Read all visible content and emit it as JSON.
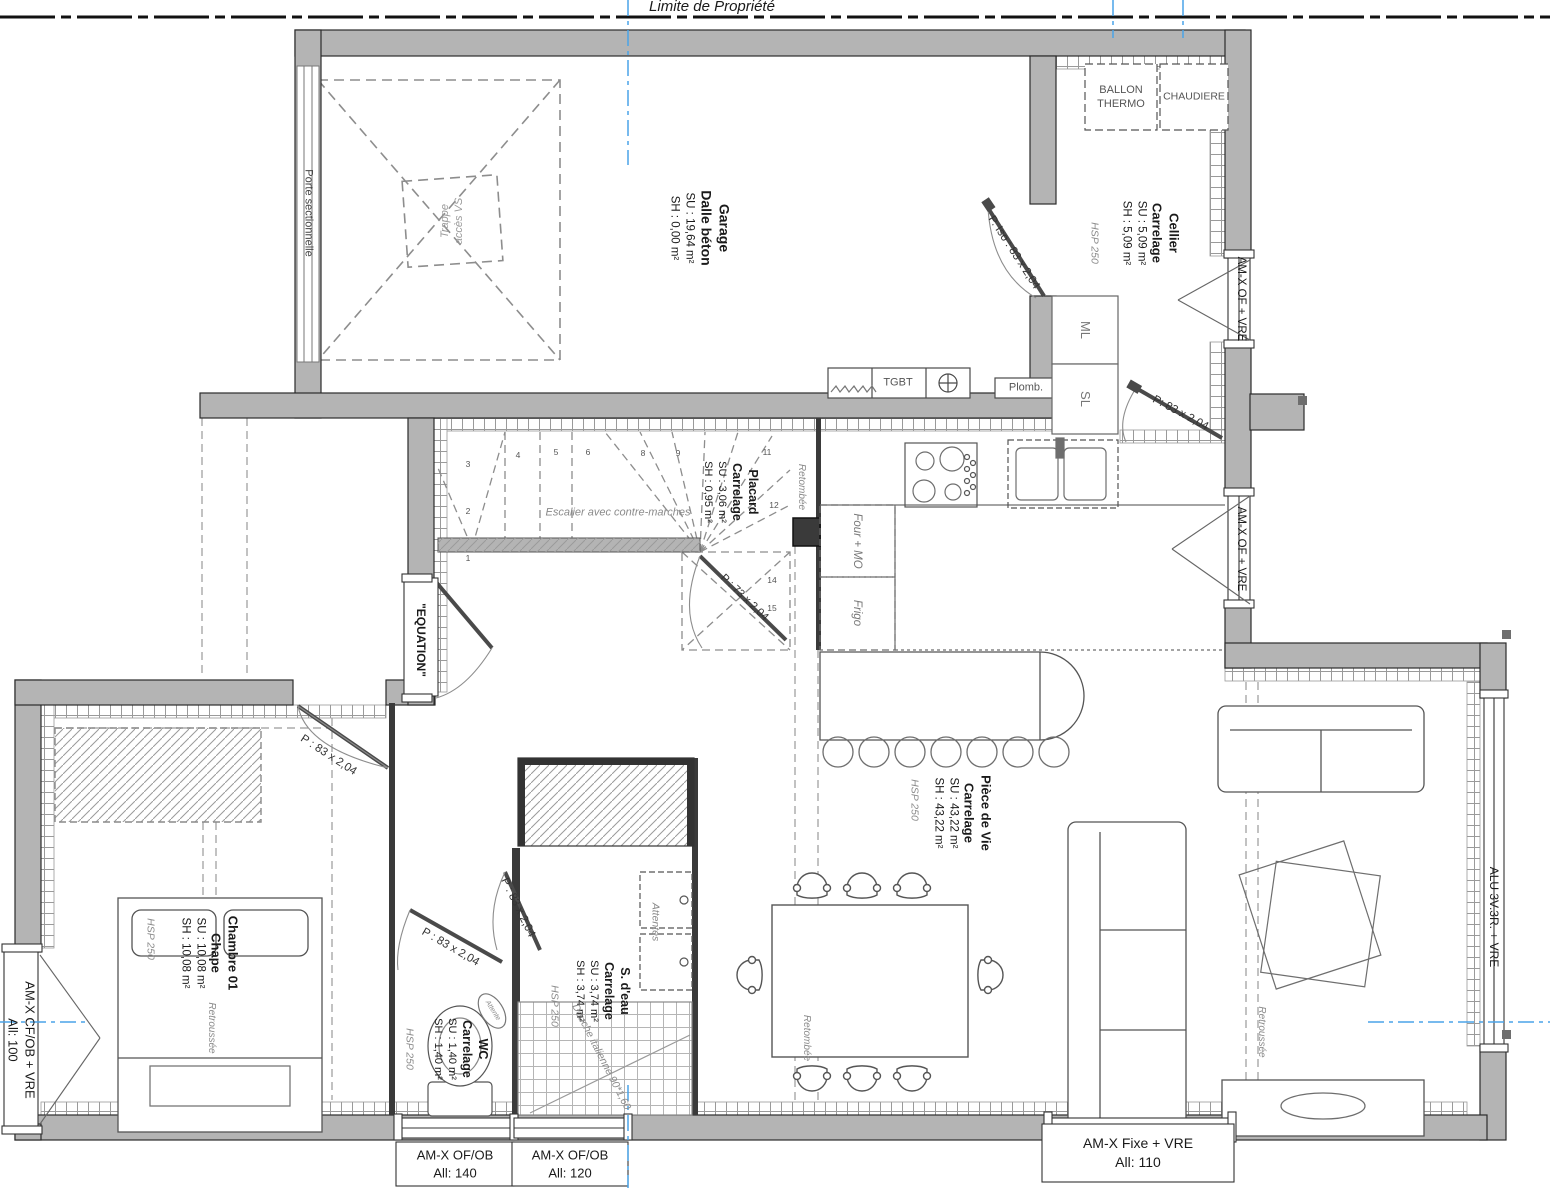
{
  "property_line_label": "Limite de Propriété",
  "colors": {
    "wall": "#b4b4b4",
    "axis_blue": "#4aa3e8",
    "muted_text": "#8a8a8a",
    "line": "#2e2e2e"
  },
  "rooms": {
    "garage": {
      "name": "Garage",
      "floor": "Dalle béton",
      "su": "SU : 19,64 m²",
      "sh": "SH : 0,00 m²"
    },
    "cellier": {
      "name": "Cellier",
      "floor": "Carrelage",
      "su": "SU : 5,09 m²",
      "sh": "SH : 5,09 m²",
      "hsp": "HSP 250"
    },
    "placard": {
      "name": "Placard",
      "floor": "Carrelage",
      "su": "SU : 3,06 m²",
      "sh": "SH : 0,95 m²"
    },
    "piece_de_vie": {
      "name": "Pièce de Vie",
      "floor": "Carrelage",
      "su": "SU : 43,22 m²",
      "sh": "SH : 43,22 m²",
      "hsp": "HSP 250"
    },
    "chambre": {
      "name": "Chambre 01",
      "floor": "Chape",
      "su": "SU : 10,08 m²",
      "sh": "SH : 10,08 m²",
      "hsp": "HSP 250"
    },
    "wc": {
      "name": "WC",
      "floor": "Carrelage",
      "su": "SU : 1,40 m²",
      "sh": "SH : 1,40 m²",
      "hsp": "HSP 250"
    },
    "sdeau": {
      "name": "S. d'eau",
      "floor": "Carrelage",
      "su": "SU : 3,74 m²",
      "sh": "SH : 3,74 m²",
      "hsp": "HSP 250"
    }
  },
  "labels": {
    "porte_sectionnelle": "Porte sectionnelle",
    "trappe_l1": "Trappe",
    "trappe_l2": "accès VS",
    "equation": "\"EQUATION\"",
    "escalier": "Escalier avec contre-marches",
    "retombee": "Retombée",
    "retroussee": "Retroussée",
    "attente": "Attente",
    "attentes": "Attentes",
    "douche": "Douche italienne 90*1,60",
    "tgbt": "TGBT",
    "plomb": "Plomb.",
    "ballon_l1": "BALLON",
    "ballon_l2": "THERMO",
    "chaudiere": "CHAUDIERE",
    "ml": "ML",
    "sl": "SL",
    "four_mo": "Four + MO",
    "frigo": "Frigo"
  },
  "doors": {
    "cellier_iso": "P. Iso : 83 x 2,04",
    "cellier": "P: 83 x 2,04",
    "placard": "P : 73 x 2,04",
    "chambre": "P : 83 x 2,04",
    "wc": "P : 83 x 2,04",
    "sdeau": "P : 83 x 2,04"
  },
  "windows": {
    "left": {
      "l1": "AM-X CF/OB + VRE",
      "l2": "All: 100"
    },
    "bottom_140": {
      "l1": "AM-X OF/OB",
      "l2": "All: 140"
    },
    "bottom_120": {
      "l1": "AM-X OF/OB",
      "l2": "All: 120"
    },
    "bottom_fixe": {
      "l1": "AM-X Fixe + VRE",
      "l2": "All: 110"
    },
    "right_of_1": "AM-X OF + VRE",
    "right_of_2": "AM-X OF + VRE",
    "alu": "ALU 3V.3R. + VRE"
  },
  "stairs": {
    "steps": [
      "1",
      "2",
      "3",
      "4",
      "5",
      "6",
      "8",
      "9",
      "11",
      "12",
      "14",
      "15"
    ]
  }
}
